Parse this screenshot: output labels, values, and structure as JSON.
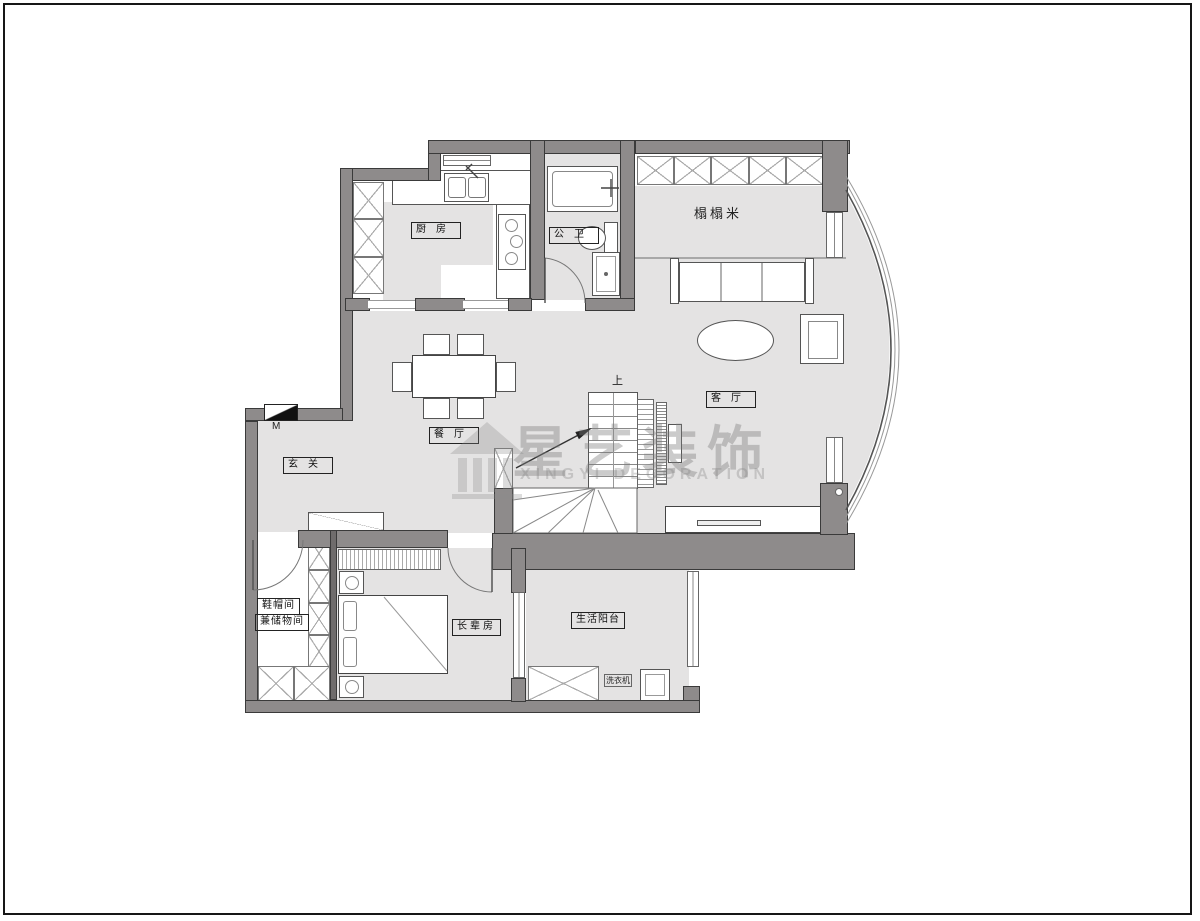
{
  "rooms": {
    "kitchen": "厨房",
    "bathroom": "公卫",
    "tatami": "榻榻米",
    "dining": "餐厅",
    "entry": "玄关",
    "living": "客厅",
    "cloakroom_line1": "鞋帽间",
    "cloakroom_line2": "兼储物间",
    "elder_room": "长辈房",
    "balcony": "生活阳台"
  },
  "appliances": {
    "washing_machine": "洗衣机"
  },
  "stairs": {
    "direction": "上"
  },
  "markers": {
    "entry_door": "M"
  },
  "watermark": {
    "cn": "星艺装饰",
    "en": "XINGYI DECORATION"
  },
  "colors": {
    "wall": "#8e8b8b",
    "floor": "#e4e3e3"
  }
}
